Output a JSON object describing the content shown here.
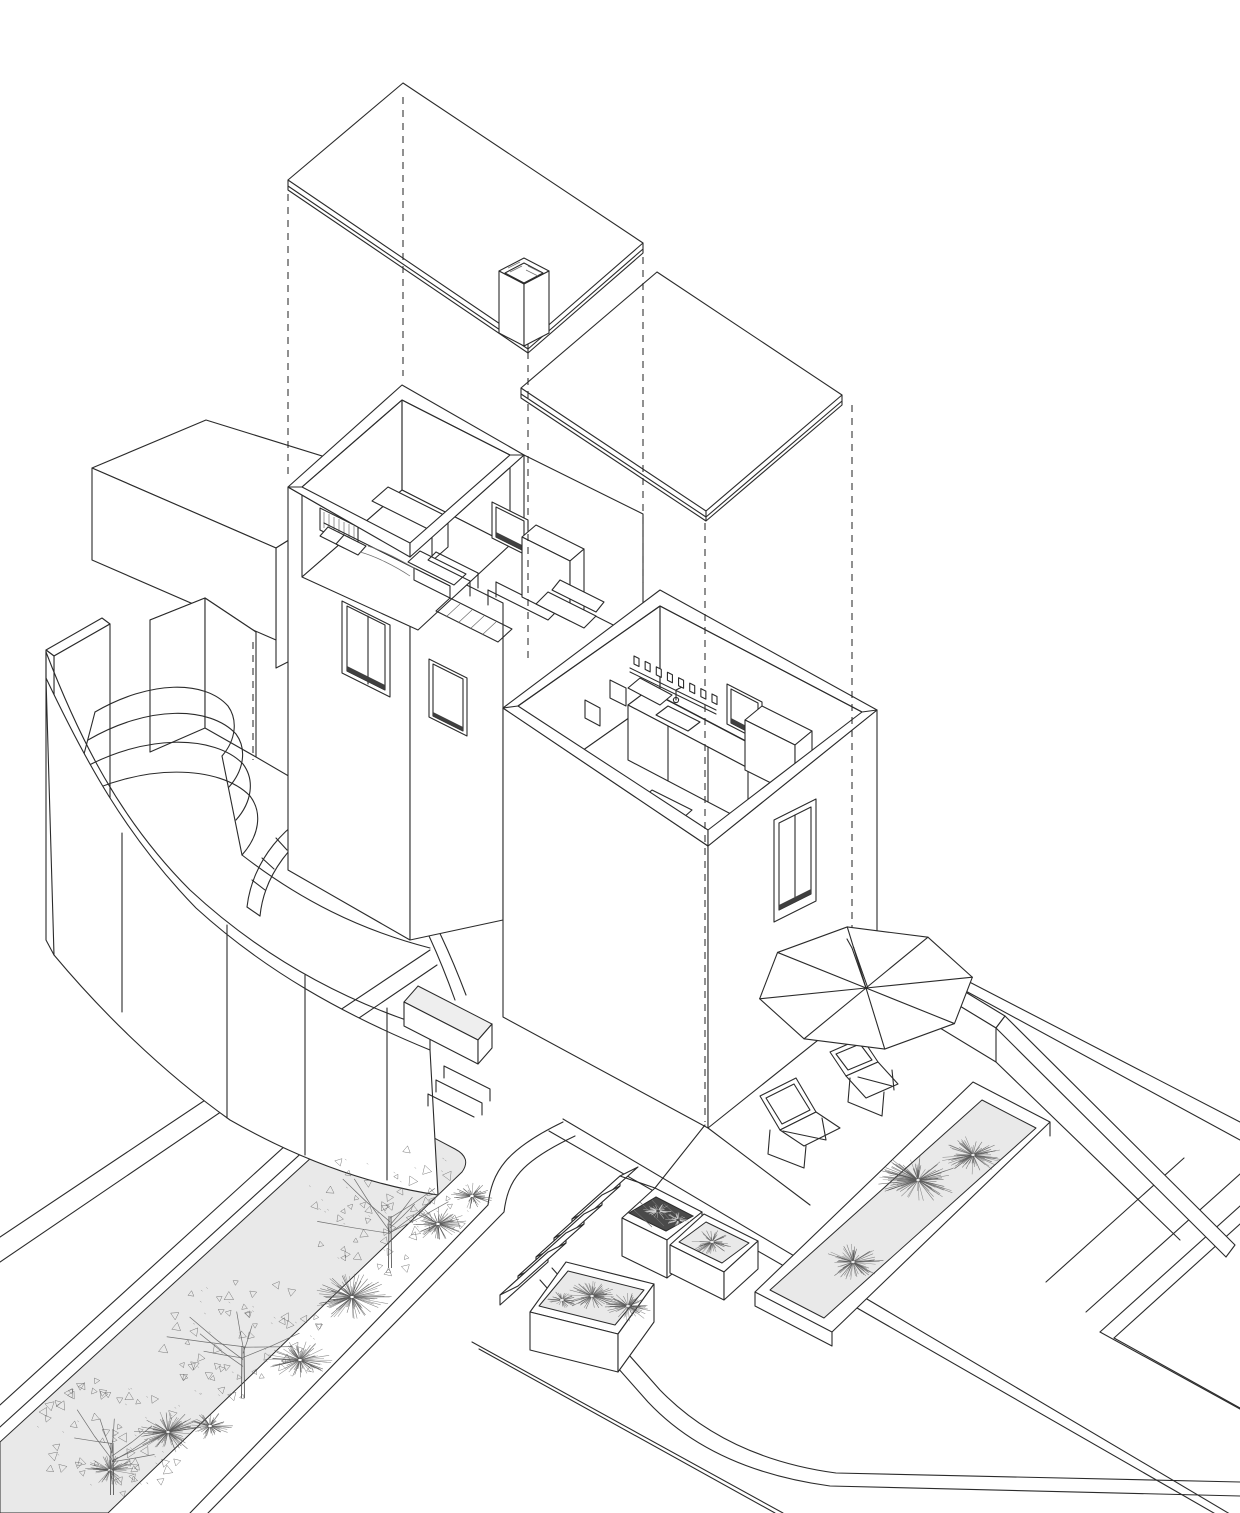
{
  "drawing": {
    "kind": "axonometric exploded architectural drawing",
    "subject": "two-storey house with exploded roof planes, furnished bedroom and kitchen volumes, curved garden wall with amphitheater steps, roof terrace with parasol and lounge chairs, planters with grasses and trees",
    "background": "#ffffff"
  },
  "palette": {
    "paper": "#ffffff",
    "line": "#2b2b2b",
    "linelight": "#6f6f6f",
    "plant": "#5a5a5a",
    "plantlight": "#dcdcdc",
    "bed": "#e9e9e9",
    "bedlight": "#eeeeee",
    "darkbed": "#4a4a4a",
    "sill": "#3f3f3f",
    "dash_pattern": "7 6"
  },
  "projection_lines": [
    {
      "x": 288,
      "y1": 194,
      "y2": 478
    },
    {
      "x": 403,
      "y1": 97,
      "y2": 376
    },
    {
      "x": 528,
      "y1": 352,
      "y2": 658
    },
    {
      "x": 643,
      "y1": 257,
      "y2": 583
    },
    {
      "x": 705,
      "y1": 523,
      "y2": 1122
    },
    {
      "x": 852,
      "y1": 405,
      "y2": 942
    },
    {
      "x": 253,
      "y1": 642,
      "y2": 760
    }
  ],
  "vegetation": {
    "grass_tufts": [
      {
        "x": 918,
        "y": 1180,
        "r": 42
      },
      {
        "x": 973,
        "y": 1155,
        "r": 33
      },
      {
        "x": 853,
        "y": 1262,
        "r": 31
      },
      {
        "x": 352,
        "y": 1297,
        "r": 40
      },
      {
        "x": 300,
        "y": 1360,
        "r": 33
      },
      {
        "x": 168,
        "y": 1432,
        "r": 35
      },
      {
        "x": 210,
        "y": 1426,
        "r": 24
      },
      {
        "x": 438,
        "y": 1224,
        "r": 29
      },
      {
        "x": 472,
        "y": 1196,
        "r": 22
      },
      {
        "x": 110,
        "y": 1470,
        "r": 26
      },
      {
        "x": 592,
        "y": 1296,
        "r": 27
      },
      {
        "x": 628,
        "y": 1306,
        "r": 27
      },
      {
        "x": 562,
        "y": 1300,
        "r": 15
      },
      {
        "x": 712,
        "y": 1242,
        "r": 21
      }
    ],
    "dark_bed_tufts": [
      {
        "x": 658,
        "y": 1211,
        "r": 15
      },
      {
        "x": 678,
        "y": 1220,
        "r": 13
      }
    ],
    "trees": [
      {
        "x": 390,
        "y": 1268,
        "r": 88
      },
      {
        "x": 243,
        "y": 1398,
        "r": 85
      },
      {
        "x": 112,
        "y": 1495,
        "r": 80
      }
    ]
  },
  "furniture": {
    "umbrella": {
      "cx": 866,
      "cy": 988,
      "rx": 108,
      "ry": 62,
      "panels": 8,
      "rot_deg": -10,
      "pole_top_x": 852,
      "pole_top_y": 948
    },
    "lounge_chairs": 2,
    "kitchen_shelf": {
      "x1": 634,
      "y1": 664,
      "x2": 712,
      "y2": 702,
      "jars": 8
    }
  }
}
